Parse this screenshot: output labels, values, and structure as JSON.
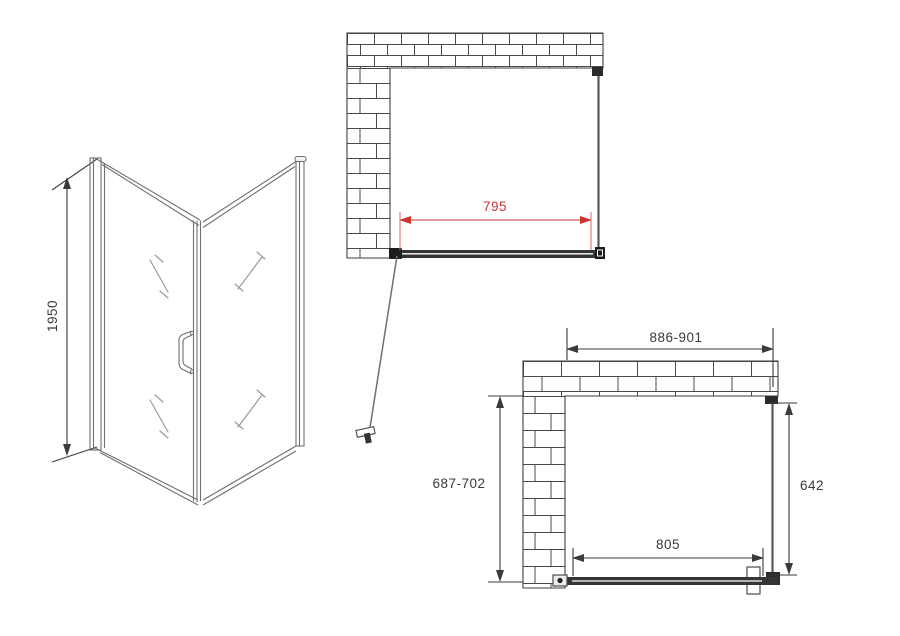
{
  "drawing": {
    "title": "corner-shower-enclosure-technical-drawing",
    "colors": {
      "background": "#ffffff",
      "outline": "#3f3f3f",
      "light_line": "#6f6f6f",
      "dimension_red": "#cc3333",
      "dimension_black": "#3a3a3a",
      "profile_dark": "#2b2b2b"
    },
    "perspective_view": {
      "height_dim": "1950"
    },
    "top_plan_view": {
      "door_width_dim": "795"
    },
    "bottom_plan_view": {
      "overall_width_dim": "886-901",
      "depth_dim": "687-702",
      "side_panel_dim": "642",
      "door_glass_width_dim": "805"
    }
  }
}
